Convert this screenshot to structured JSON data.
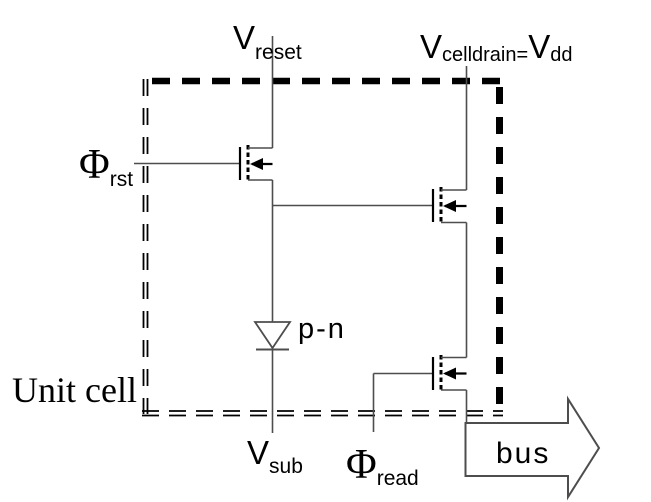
{
  "figure": {
    "type": "circuit-diagram",
    "description_labels": {
      "v_reset": {
        "base": "V",
        "sub": "reset"
      },
      "v_celldrain": {
        "base": "V",
        "sub": "celldrain",
        "equals": "=",
        "base2": "V",
        "sub2": "dd"
      },
      "phi_rst": {
        "base": "Φ",
        "sub": "rst"
      },
      "phi_read": {
        "base": "Φ",
        "sub": "read"
      },
      "v_sub": {
        "base": "V",
        "sub": "sub"
      },
      "photodiode_label": "p-n",
      "bus_label": "bus",
      "unit_cell_label": "Unit cell"
    },
    "symbols": {
      "boundary": "unit-cell-dashed-boundary",
      "transistor_reset": "nmos-transistor-icon",
      "transistor_source_follower": "nmos-transistor-icon",
      "transistor_read_select": "nmos-transistor-icon",
      "photodiode": "diode-down-icon",
      "bus_output": "block-arrow-right-icon"
    },
    "colors": {
      "wire": "#4d4d4d",
      "symbol": "#000000",
      "background": "#ffffff"
    }
  }
}
